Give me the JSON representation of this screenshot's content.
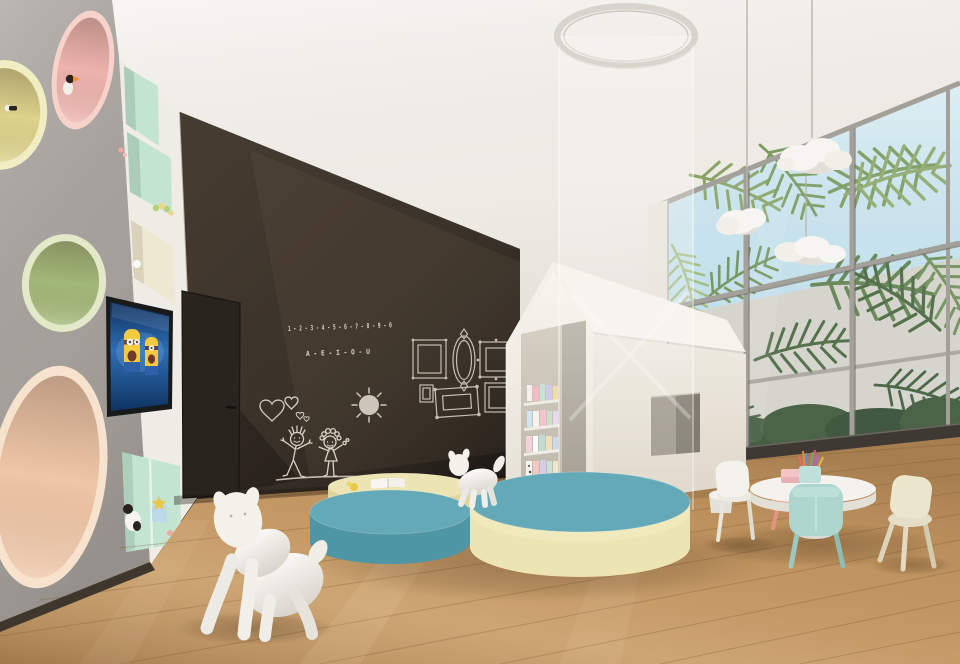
{
  "scene": {
    "chalkboard": {
      "number_line": "1 - 2 - 3 - 4 - 5 - 6 - 7 - 8 - 9 - 0",
      "vowel_line": "A - E - I - O - U"
    },
    "palette": {
      "ceiling": "#f2efe9",
      "wall_gray": "#a7a29d",
      "niche_strip": "#efece6",
      "circle_pink": "#edb3ad",
      "circle_pink_rim": "#f6d2cb",
      "circle_yellow": "#dcd28a",
      "circle_yellow_rim": "#f1edc2",
      "circle_green": "#a2b877",
      "circle_green_rim": "#e3e9c8",
      "circle_peach": "#efc6a6",
      "circle_peach_rim": "#f7e2cd",
      "shelf_mint": "#c4e4d2",
      "shelf_cream": "#eee7d2",
      "chalkboard_dark": "#332b24",
      "chalk": "#e6dfd2",
      "door": "#2a241f",
      "floor_wood": "#bf9461",
      "pouf_blue": "#63a9b7",
      "pouf_blue_side": "#4f96a4",
      "pouf_cream": "#ece4b2",
      "pouf_cream_side": "#dfd59d",
      "playhouse": "#f3efe8",
      "playhouse_side": "#e7e1d7",
      "sky": "#c4e2ee",
      "outside_wall": "#d8d3c8",
      "foliage": "#6f8f57",
      "cloud_lamp": "#f7f5f1",
      "table_white": "#f4f2ed",
      "chair_mint": "#abd5cd",
      "chair_cream": "#ebe5cc",
      "chair_white": "#f4f2ec",
      "stool_pink": "#ef9e93",
      "tv_screen": "#2a62a8",
      "minion_yellow": "#f2cb3e",
      "puppy_white": "#f4f1ea"
    }
  }
}
